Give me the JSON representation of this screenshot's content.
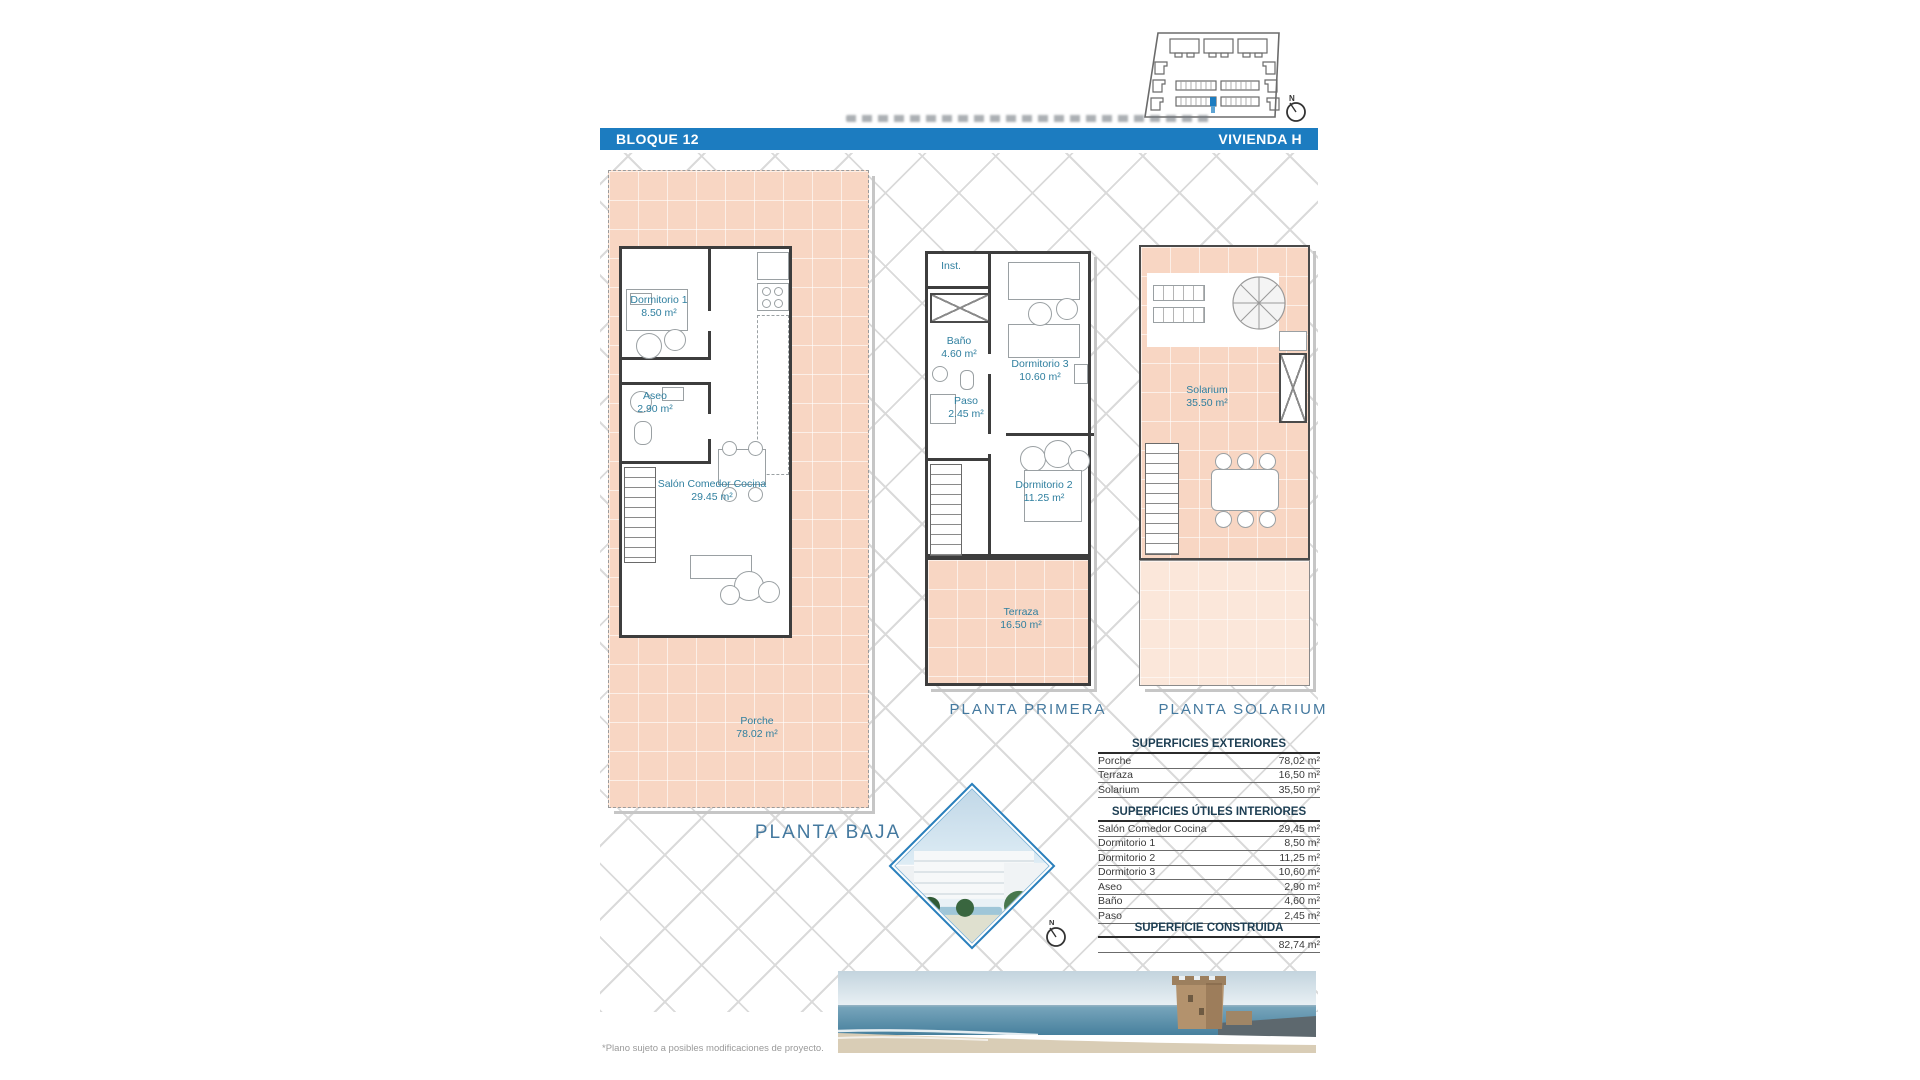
{
  "header": {
    "left": "BLOQUE 12",
    "right": "VIVIENDA H"
  },
  "compass": {
    "label": "N"
  },
  "plans": [
    {
      "title": "PLANTA BAJA",
      "rooms": [
        {
          "name": "Dormitorio 1",
          "area": "8.50 m²"
        },
        {
          "name": "Aseo",
          "area": "2.90 m²"
        },
        {
          "name": "Salón Comedor Cocina",
          "area": "29.45 m²"
        },
        {
          "name": "Porche",
          "area": "78.02 m²"
        }
      ]
    },
    {
      "title": "PLANTA PRIMERA",
      "rooms": [
        {
          "name": "Inst.",
          "area": ""
        },
        {
          "name": "Baño",
          "area": "4.60 m²"
        },
        {
          "name": "Paso",
          "area": "2.45 m²"
        },
        {
          "name": "Dormitorio 3",
          "area": "10.60 m²"
        },
        {
          "name": "Dormitorio 2",
          "area": "11.25 m²"
        },
        {
          "name": "Terraza",
          "area": "16.50 m²"
        }
      ]
    },
    {
      "title": "PLANTA SOLARIUM",
      "rooms": [
        {
          "name": "Solarium",
          "area": "35.50 m²"
        }
      ]
    }
  ],
  "tables": {
    "exteriores": {
      "title": "SUPERFICIES EXTERIORES",
      "rows": [
        {
          "label": "Porche",
          "value": "78,02 m²"
        },
        {
          "label": "Terraza",
          "value": "16,50 m²"
        },
        {
          "label": "Solarium",
          "value": "35,50 m²"
        }
      ]
    },
    "interiores": {
      "title": "SUPERFICIES ÚTILES INTERIORES",
      "rows": [
        {
          "label": "Salón Comedor Cocina",
          "value": "29,45 m²"
        },
        {
          "label": "Dormitorio 1",
          "value": "8,50 m²"
        },
        {
          "label": "Dormitorio 2",
          "value": "11,25 m²"
        },
        {
          "label": "Dormitorio 3",
          "value": "10,60 m²"
        },
        {
          "label": "Aseo",
          "value": "2,90 m²"
        },
        {
          "label": "Baño",
          "value": "4,60 m²"
        },
        {
          "label": "Paso",
          "value": "2,45 m²"
        }
      ]
    },
    "construida": {
      "title": "SUPERFICIE CONSTRUIDA",
      "value": "82,74 m²"
    }
  },
  "footnote": "*Plano sujeto a posibles modificaciones de proyecto.",
  "colors": {
    "accent": "#1c7cc0",
    "title_blue": "#44799f",
    "room_label": "#2f7f9f",
    "salmon": "#f8d6c3"
  }
}
